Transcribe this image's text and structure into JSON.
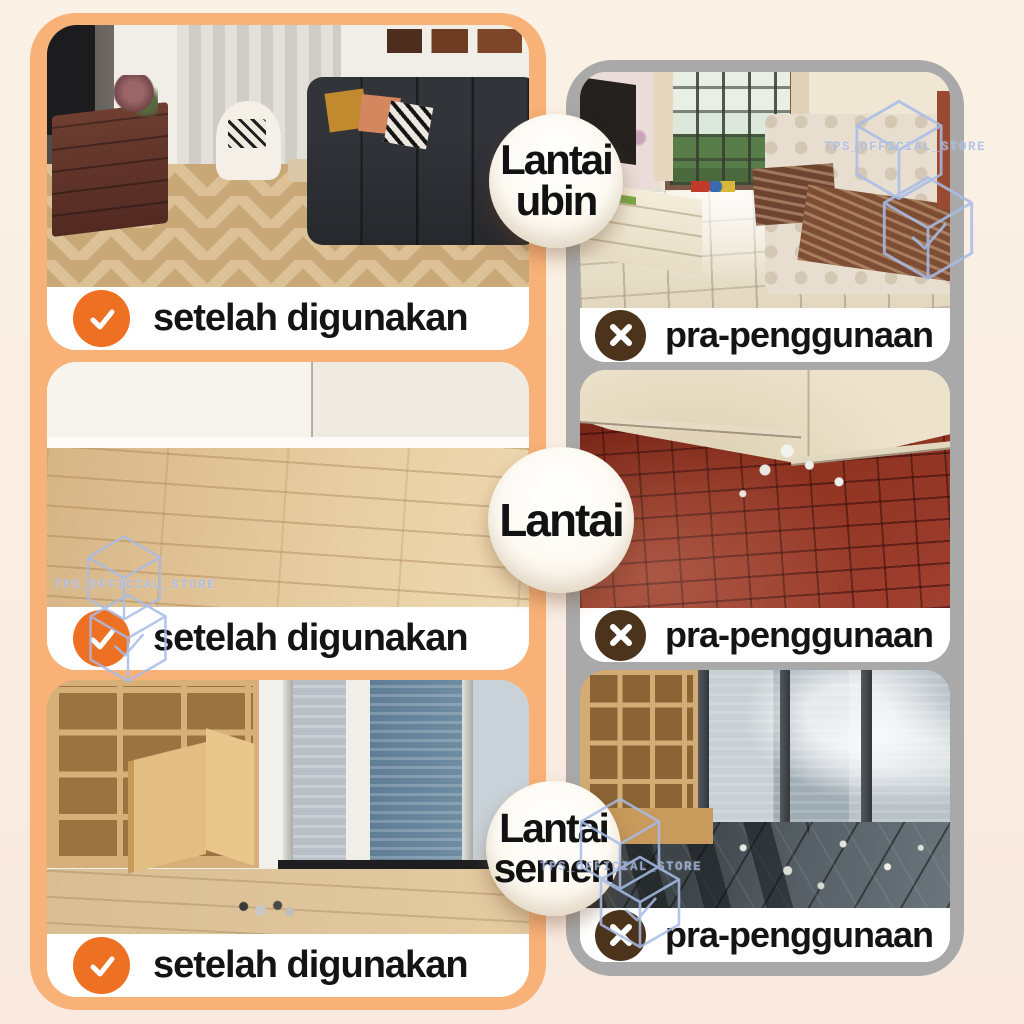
{
  "page": {
    "background": "#FAEEE2"
  },
  "badges": [
    {
      "lines": [
        "Lantai",
        "ubin"
      ]
    },
    {
      "lines": [
        "Lantai",
        ""
      ]
    },
    {
      "lines": [
        "Lantai",
        "semen"
      ]
    }
  ],
  "after_column": {
    "panel_color": "#F8B177",
    "check_color": "#EE7023",
    "items": [
      {
        "label": "setelah digunakan"
      },
      {
        "label": "setelah digunakan"
      },
      {
        "label": "setelah digunakan"
      }
    ]
  },
  "before_column": {
    "panel_color": "#A9A9A9",
    "x_color": "#4C341C",
    "items": [
      {
        "label": "pra-penggunaan"
      },
      {
        "label": "pra-penggunaan"
      },
      {
        "label": "pra-penggunaan"
      }
    ]
  },
  "watermark": {
    "text": "TPS_OFFICIAL_STORE",
    "color": "#A8BCE8"
  }
}
